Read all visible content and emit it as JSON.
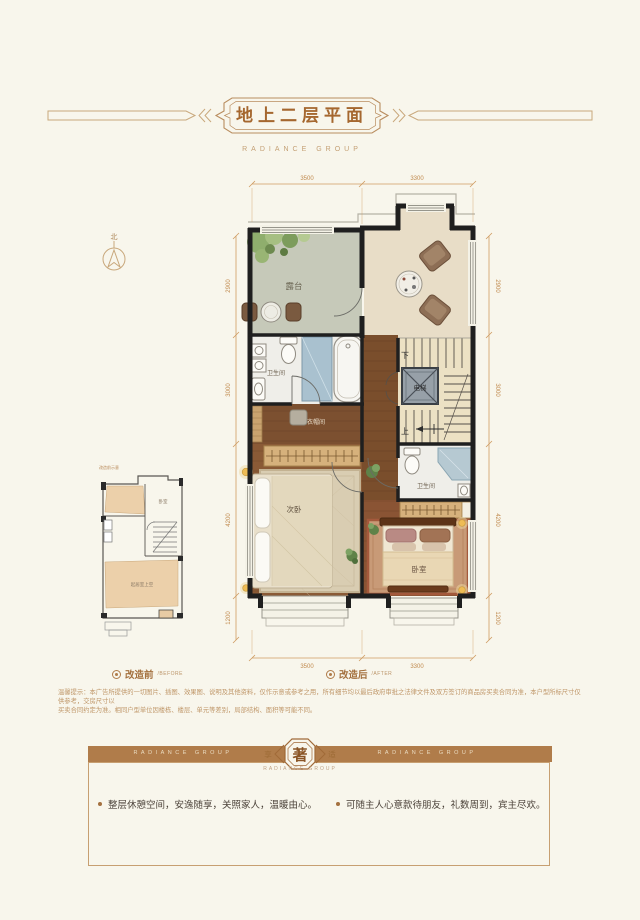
{
  "page": {
    "bg": "#f8f6ec"
  },
  "header": {
    "title": "地上二层平面",
    "subtitle": "RADIANCE GROUP"
  },
  "compass": {
    "north": "北"
  },
  "plan": {
    "dims_top": [
      "3500",
      "3300"
    ],
    "dims_bottom": [
      "3500",
      "3300"
    ],
    "dims_left": [
      "2900",
      "3000",
      "4200",
      "1200"
    ],
    "dims_right": [
      "2900",
      "3000",
      "4200",
      "1200"
    ],
    "rooms": {
      "terrace": "露台",
      "bath1": "卫生间",
      "closet": "衣帽间",
      "elevator": "电梯",
      "stairs_down": "下",
      "stairs_up": "上",
      "bath2": "卫生间",
      "bedroom2": "次卧",
      "master": "卧室"
    }
  },
  "small_plan": {
    "note": "改造前示意",
    "bedroom": "卧室",
    "void_label": "起居室上空"
  },
  "legend": {
    "before": "改造前",
    "before_en": "/BEFORE",
    "after": "改造后",
    "after_en": "/AFTER"
  },
  "disclaimer": {
    "line1": "温馨提示：本广告所提供的一切图片、插图、效果图、说明及其他资料，仅作示意或参考之用，所有细节均以最后政府审批之法律文件及双方签订的商品房买卖合同为准，本户型所标尺寸仅供参考，交房尺寸以",
    "line2": "买卖合同约定为准。相同户型单位因楼栋、楼层、单元等差别，局部结构、面积等可能不同。"
  },
  "banner": {
    "left": "RADIANCE GROUP",
    "right": "RADIANCE GROUP",
    "emblem_left": "享",
    "emblem_center": "著",
    "emblem_right": "适",
    "sub": "RADIANCE GROUP"
  },
  "footer": {
    "bullet1": "整层休憩空间，安逸随享，关照家人，温暖由心。",
    "bullet2": "可随主人心意款待朋友，礼数周到，宾主尽欢。"
  },
  "colors": {
    "accent": "#a5672f",
    "gold_line": "#c9a87c",
    "dim": "#c08a4e",
    "banner": "#b07c4a",
    "wall": "#1f1f1f",
    "wood": "#8a5a36",
    "marble": "#e8ddc7",
    "stone": "#c6c9b9"
  }
}
